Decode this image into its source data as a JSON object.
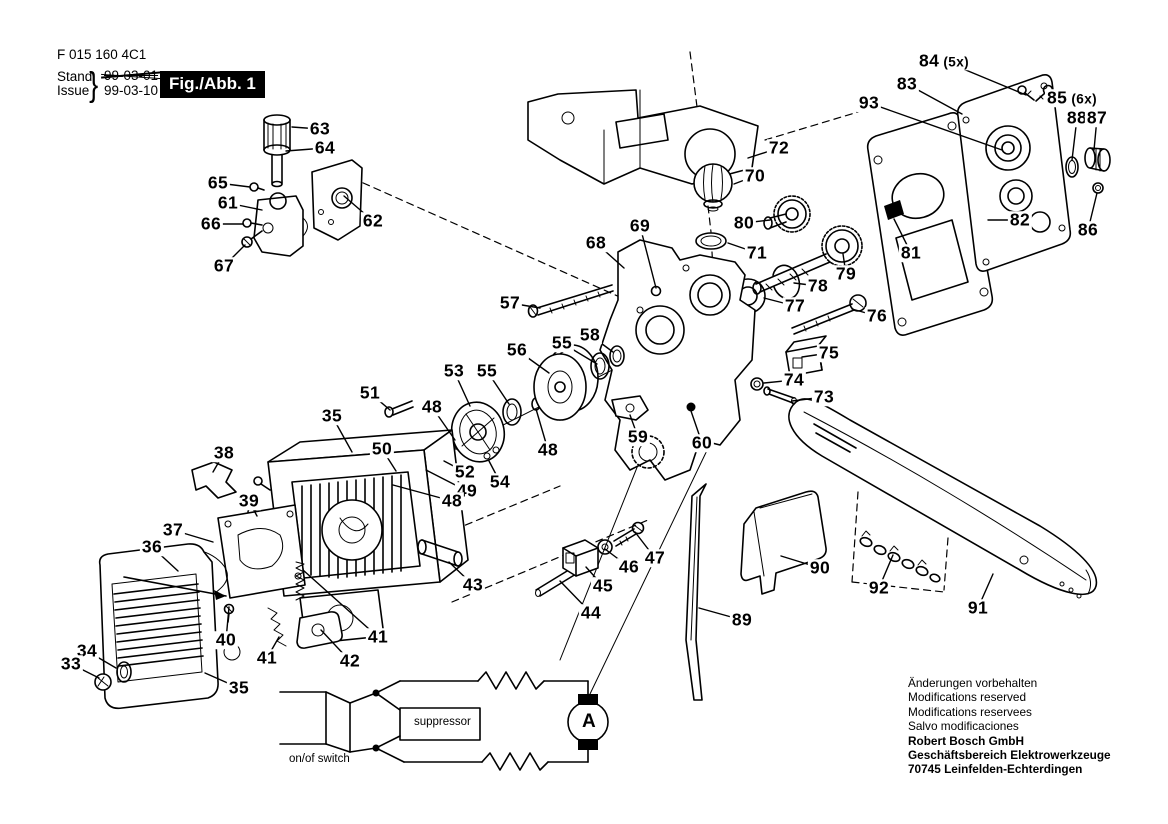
{
  "colors": {
    "ink": "#000000",
    "paper": "#ffffff",
    "figure_box_bg": "#000000",
    "figure_box_text": "#ffffff"
  },
  "header": {
    "part_code": "F 015 160 4C1",
    "stand_label": "Stand",
    "issue_label": "Issue",
    "brace": "}",
    "old_date": "99-03-01",
    "new_date": "99-03-10",
    "figure_label": "Fig./Abb. 1"
  },
  "footer": {
    "lines": [
      "Änderungen vorbehalten",
      "Modifications reserved",
      "Modifications reservees",
      "Salvo modificaciones"
    ],
    "bold_lines": [
      "Robert Bosch GmbH",
      "Geschäftsbereich Elektrowerkzeuge",
      "70745 Leinfelden-Echterdingen"
    ]
  },
  "circuit": {
    "switch_label": "on/of switch",
    "suppressor_label": "suppressor",
    "motor_label": "A"
  },
  "diagram": {
    "callouts": [
      {
        "n": "63",
        "x": 320,
        "y": 129,
        "lx": 292,
        "ly": 127
      },
      {
        "n": "64",
        "x": 325,
        "y": 148,
        "lx": 286,
        "ly": 151
      },
      {
        "n": "65",
        "x": 218,
        "y": 183,
        "lx": 250,
        "ly": 187
      },
      {
        "n": "61",
        "x": 228,
        "y": 203,
        "lx": 262,
        "ly": 210
      },
      {
        "n": "66",
        "x": 211,
        "y": 224,
        "lx": 243,
        "ly": 224
      },
      {
        "n": "62",
        "x": 373,
        "y": 221,
        "lx": 344,
        "ly": 196
      },
      {
        "n": "67",
        "x": 224,
        "y": 266,
        "lx": 245,
        "ly": 245
      },
      {
        "n": "72",
        "x": 779,
        "y": 148,
        "lx": 748,
        "ly": 158
      },
      {
        "n": "70",
        "x": 755,
        "y": 176,
        "lx": 734,
        "ly": 184
      },
      {
        "n": "80",
        "x": 744,
        "y": 223,
        "lx": 770,
        "ly": 220
      },
      {
        "n": "69",
        "x": 640,
        "y": 226,
        "lx": 656,
        "ly": 288
      },
      {
        "n": "68",
        "x": 596,
        "y": 243,
        "lx": 624,
        "ly": 268
      },
      {
        "n": "71",
        "x": 757,
        "y": 253,
        "lx": 728,
        "ly": 243
      },
      {
        "n": "79",
        "x": 846,
        "y": 274,
        "lx": 843,
        "ly": 254
      },
      {
        "n": "78",
        "x": 818,
        "y": 286,
        "lx": 794,
        "ly": 283
      },
      {
        "n": "77",
        "x": 795,
        "y": 306,
        "lx": 764,
        "ly": 298
      },
      {
        "n": "76",
        "x": 877,
        "y": 316,
        "lx": 852,
        "ly": 309
      },
      {
        "n": "75",
        "x": 829,
        "y": 353,
        "lx": 802,
        "ly": 357
      },
      {
        "n": "74",
        "x": 794,
        "y": 380,
        "lx": 764,
        "ly": 383
      },
      {
        "n": "73",
        "x": 824,
        "y": 397,
        "lx": 792,
        "ly": 401
      },
      {
        "n": "57",
        "x": 510,
        "y": 303,
        "lx": 540,
        "ly": 308
      },
      {
        "n": "58",
        "x": 590,
        "y": 335,
        "lx": 613,
        "ly": 352
      },
      {
        "n": "55",
        "x": 562,
        "y": 343,
        "lx": 597,
        "ly": 364
      },
      {
        "n": "56",
        "x": 517,
        "y": 350,
        "lx": 549,
        "ly": 373
      },
      {
        "n": "53",
        "x": 454,
        "y": 371,
        "lx": 470,
        "ly": 406
      },
      {
        "n": "55",
        "x": 487,
        "y": 371,
        "lx": 509,
        "ly": 404
      },
      {
        "n": "51",
        "x": 370,
        "y": 393,
        "lx": 390,
        "ly": 410
      },
      {
        "n": "48",
        "x": 432,
        "y": 407,
        "lx": 455,
        "ly": 440
      },
      {
        "n": "35",
        "x": 332,
        "y": 416,
        "lx": 352,
        "ly": 452
      },
      {
        "n": "50",
        "x": 382,
        "y": 449,
        "lx": 396,
        "ly": 471
      },
      {
        "n": "48",
        "x": 548,
        "y": 450,
        "lx": 536,
        "ly": 409
      },
      {
        "n": "59",
        "x": 638,
        "y": 437,
        "lx": 630,
        "ly": 415
      },
      {
        "n": "60",
        "x": 702,
        "y": 443,
        "lx": 691,
        "ly": 411
      },
      {
        "n": "52",
        "x": 465,
        "y": 472,
        "lx": 444,
        "ly": 461
      },
      {
        "n": "54",
        "x": 500,
        "y": 482,
        "lx": 489,
        "ly": 461
      },
      {
        "n": "49",
        "x": 467,
        "y": 491,
        "lx": 426,
        "ly": 470
      },
      {
        "n": "48",
        "x": 452,
        "y": 501,
        "lx": 393,
        "ly": 485
      },
      {
        "n": "38",
        "x": 224,
        "y": 453,
        "lx": 213,
        "ly": 472
      },
      {
        "n": "39",
        "x": 249,
        "y": 501,
        "lx": 257,
        "ly": 516
      },
      {
        "n": "37",
        "x": 173,
        "y": 530,
        "lx": 213,
        "ly": 542
      },
      {
        "n": "36",
        "x": 152,
        "y": 547,
        "lx": 178,
        "ly": 571
      },
      {
        "n": "40",
        "x": 226,
        "y": 640,
        "lx": 229,
        "ly": 607
      },
      {
        "n": "34",
        "x": 87,
        "y": 651,
        "lx": 116,
        "ly": 668
      },
      {
        "n": "33",
        "x": 71,
        "y": 664,
        "lx": 99,
        "ly": 678
      },
      {
        "n": "41",
        "x": 267,
        "y": 658,
        "lx": 279,
        "ly": 637
      },
      {
        "n": "41",
        "x": 378,
        "y": 637,
        "lx": 303,
        "ly": 570
      },
      {
        "n": "42",
        "x": 350,
        "y": 661,
        "lx": 321,
        "ly": 630
      },
      {
        "n": "35",
        "x": 239,
        "y": 688,
        "lx": 205,
        "ly": 673
      },
      {
        "n": "43",
        "x": 473,
        "y": 585,
        "lx": 449,
        "ly": 562
      },
      {
        "n": "44",
        "x": 591,
        "y": 613,
        "lx": 560,
        "ly": 581
      },
      {
        "n": "45",
        "x": 603,
        "y": 586,
        "lx": 586,
        "ly": 567
      },
      {
        "n": "46",
        "x": 629,
        "y": 567,
        "lx": 605,
        "ly": 549
      },
      {
        "n": "47",
        "x": 655,
        "y": 558,
        "lx": 635,
        "ly": 532
      },
      {
        "n": "89",
        "x": 742,
        "y": 620,
        "lx": 699,
        "ly": 608
      },
      {
        "n": "90",
        "x": 820,
        "y": 568,
        "lx": 781,
        "ly": 556
      },
      {
        "n": "92",
        "x": 879,
        "y": 588,
        "lx": 893,
        "ly": 555
      },
      {
        "n": "91",
        "x": 978,
        "y": 608,
        "lx": 993,
        "ly": 574
      },
      {
        "n": "84",
        "suffix": "(5x)",
        "x": 944,
        "y": 61,
        "lx": 1026,
        "ly": 95
      },
      {
        "n": "83",
        "x": 907,
        "y": 84,
        "lx": 962,
        "ly": 114
      },
      {
        "n": "93",
        "x": 869,
        "y": 103,
        "lx": 1002,
        "ly": 150
      },
      {
        "n": "85",
        "suffix": "(6x)",
        "x": 1072,
        "y": 98,
        "lx": 1050,
        "ly": 93
      },
      {
        "n": "88",
        "x": 1077,
        "y": 118,
        "lx": 1072,
        "ly": 160
      },
      {
        "n": "87",
        "x": 1097,
        "y": 118,
        "lx": 1094,
        "ly": 150
      },
      {
        "n": "82",
        "x": 1020,
        "y": 220,
        "lx": 988,
        "ly": 220
      },
      {
        "n": "86",
        "x": 1088,
        "y": 230,
        "lx": 1097,
        "ly": 193
      },
      {
        "n": "81",
        "x": 911,
        "y": 253,
        "lx": 894,
        "ly": 219
      }
    ]
  }
}
